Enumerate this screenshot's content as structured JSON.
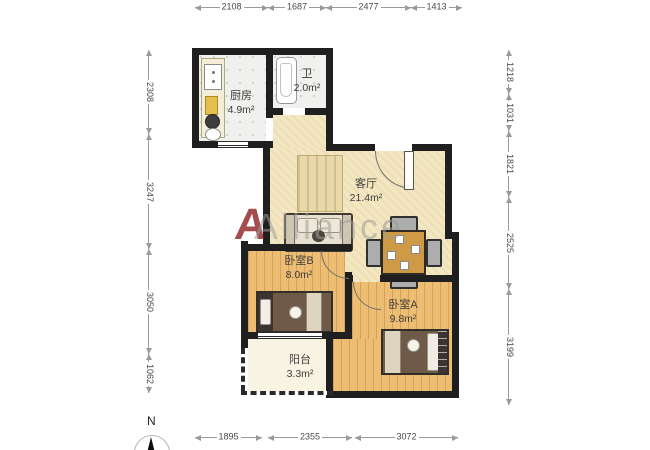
{
  "watermark": {
    "logo": "A",
    "text": "Alliance"
  },
  "compass": {
    "north_label": "N"
  },
  "rooms": {
    "kitchen": {
      "name": "厨房",
      "area": "4.9m²"
    },
    "bathroom": {
      "name": "卫",
      "area": "2.0m²"
    },
    "living": {
      "name": "客厅",
      "area": "21.4m²"
    },
    "bedroom_b": {
      "name": "卧室B",
      "area": "8.0m²"
    },
    "bedroom_a": {
      "name": "卧室A",
      "area": "9.8m²"
    },
    "balcony": {
      "name": "阳台",
      "area": "3.3m²"
    }
  },
  "dimensions": {
    "top": [
      "2108",
      "1687",
      "2477",
      "1413"
    ],
    "left": [
      "2308",
      "3247",
      "3050",
      "1062"
    ],
    "right": [
      "1218",
      "1031",
      "1821",
      "2525",
      "3199"
    ],
    "bottom": [
      "1895",
      "2355",
      "3072"
    ]
  },
  "colors": {
    "wall": "#1f1f1f",
    "living_floor": "#f3e7c3",
    "wood_floor": "#ecbd72",
    "tile_floor": "#f0f0ee",
    "balcony_floor": "#f8f3e3",
    "watermark_red": "#8e1f24",
    "watermark_gray": "#9b9b9b"
  }
}
